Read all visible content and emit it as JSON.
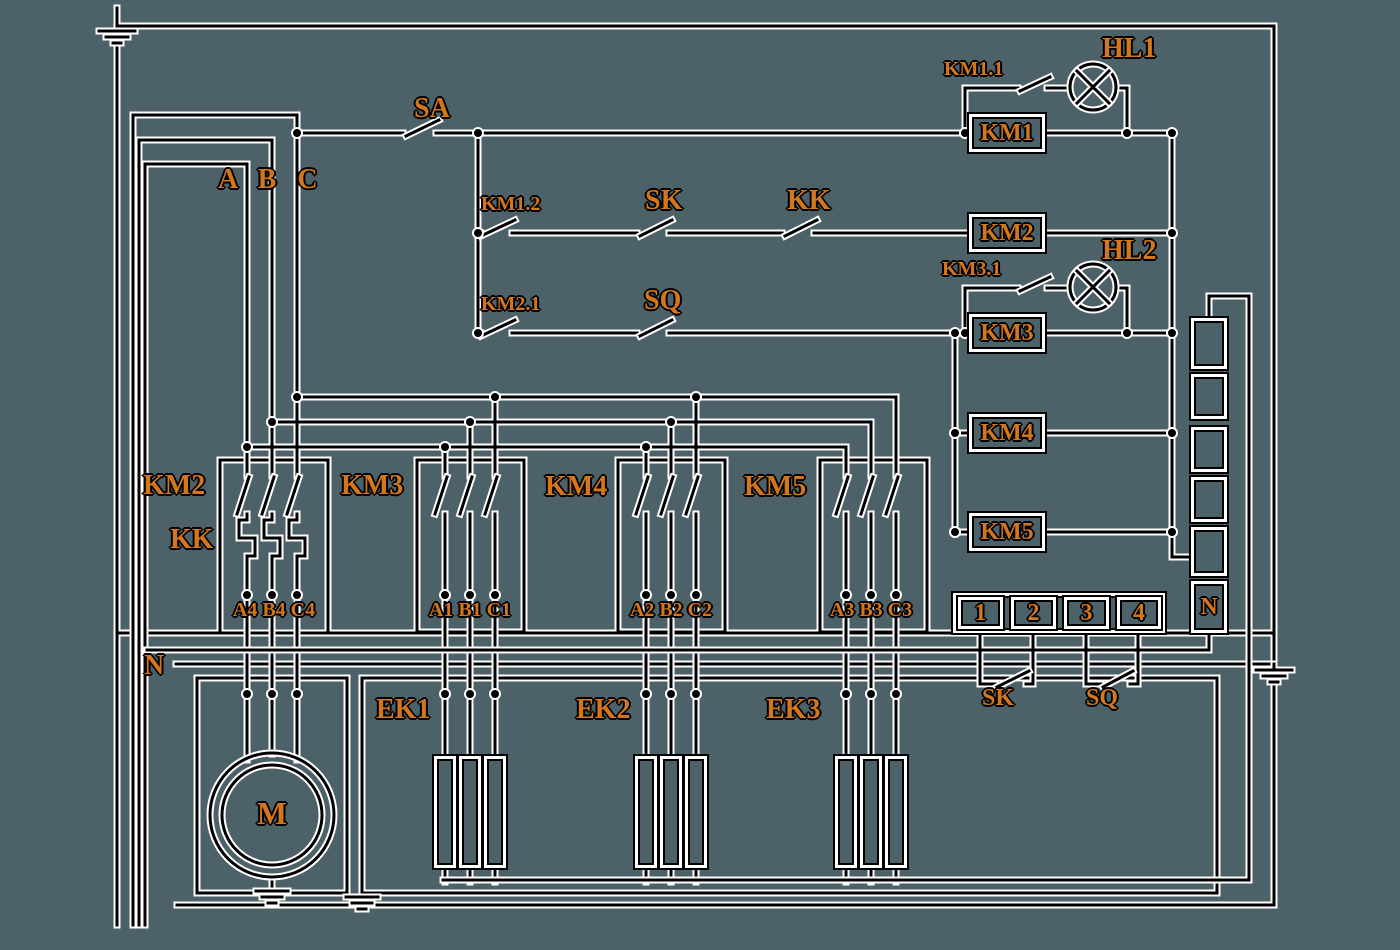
{
  "canvas": {
    "background": "#4c6168",
    "wire_color": "#000000",
    "halo_color": "#ffffff",
    "label_color": "#d4761b"
  },
  "power": {
    "phase_label": "A B C",
    "neutral_label": "N",
    "blocks": {
      "km2": "KM2",
      "kk": "KK",
      "km3": "KM3",
      "km4": "KM4",
      "km5": "KM5"
    },
    "block_terminals": {
      "km2": "A4 B4 C4",
      "km3": "A1 B1 C1",
      "km4": "A2 B2 C2",
      "km5": "A3 B3 C3"
    }
  },
  "control": {
    "sa": "SA",
    "branch_km11": "KM1.1",
    "lamp_hl1": "HL1",
    "km12": "KM1.2",
    "sk": "SK",
    "kk": "KK",
    "km21": "KM2.1",
    "sq": "SQ",
    "branch_km31": "KM3.1",
    "lamp_hl2": "HL2",
    "coils": {
      "km1": "KM1",
      "km2": "KM2",
      "km3": "KM3",
      "km4": "KM4",
      "km5": "KM5"
    }
  },
  "terminals": {
    "t1": "1",
    "t2": "2",
    "t3": "3",
    "t4": "4",
    "neutral": "N",
    "sk": "SK",
    "sq": "SQ"
  },
  "loads": {
    "motor": "M",
    "ek1": "EK1",
    "ek2": "EK2",
    "ek3": "EK3"
  }
}
